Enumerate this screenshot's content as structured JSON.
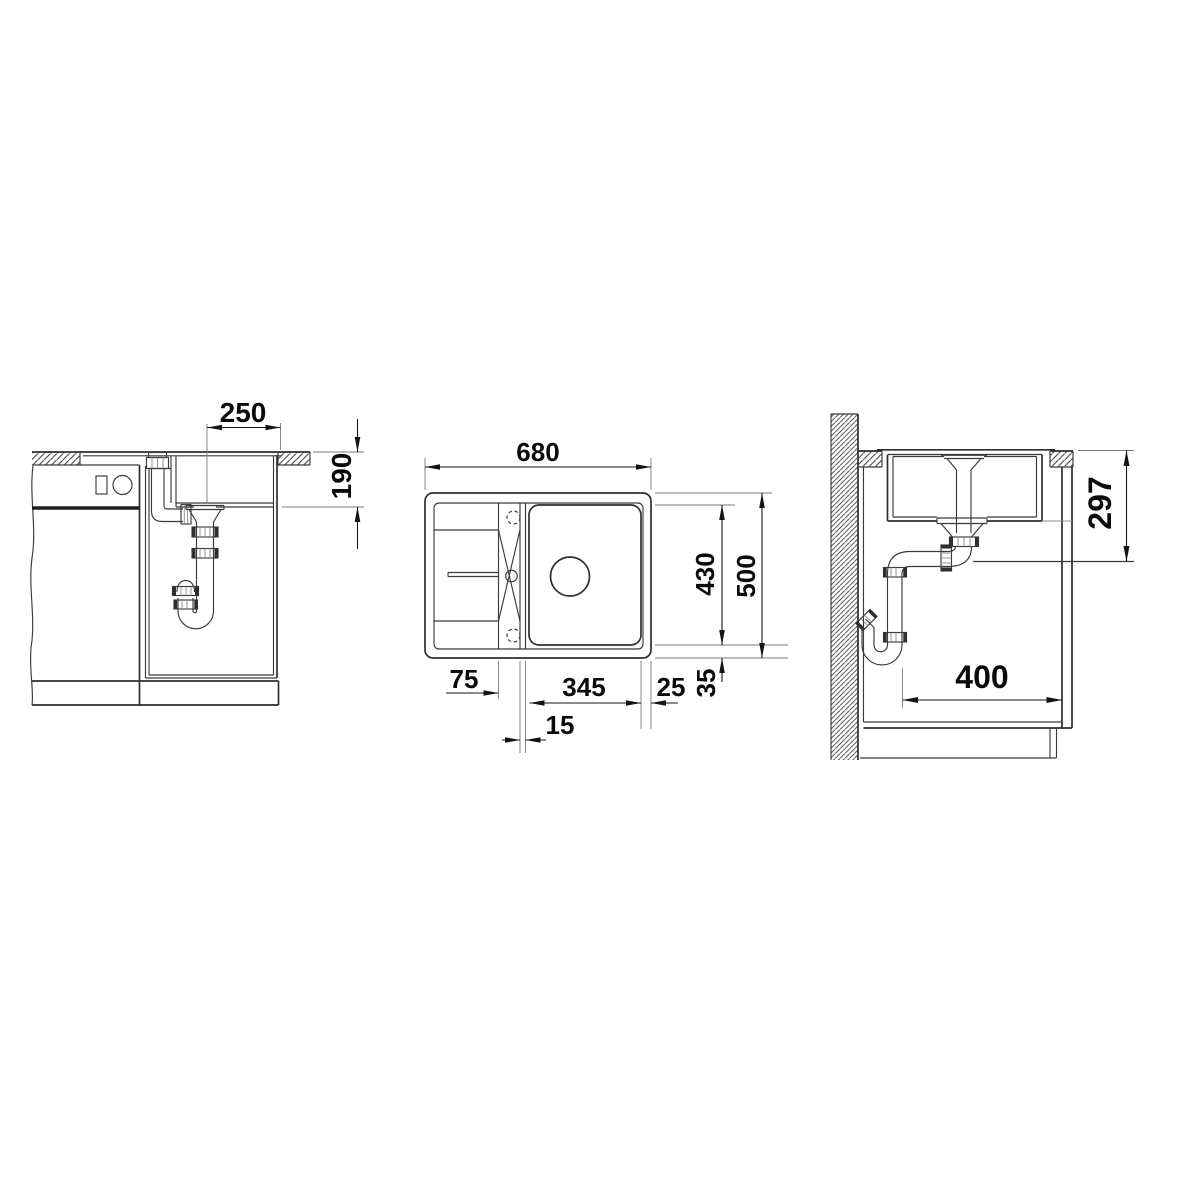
{
  "colors": {
    "background": "#ffffff",
    "drawing_line": "#2e2e2e",
    "dimension_line": "#161616",
    "dimension_text": "#0a0a0a",
    "extension_line": "#7a7a7a"
  },
  "views": {
    "front_section": {
      "dims": {
        "d250": "250",
        "d190": "190"
      }
    },
    "top_view": {
      "dims": {
        "d680": "680",
        "d430": "430",
        "d500": "500",
        "d75": "75",
        "d345": "345",
        "d25": "25",
        "d35": "35",
        "d15": "15"
      }
    },
    "side_section": {
      "dims": {
        "d297": "297",
        "d400": "400"
      }
    }
  }
}
